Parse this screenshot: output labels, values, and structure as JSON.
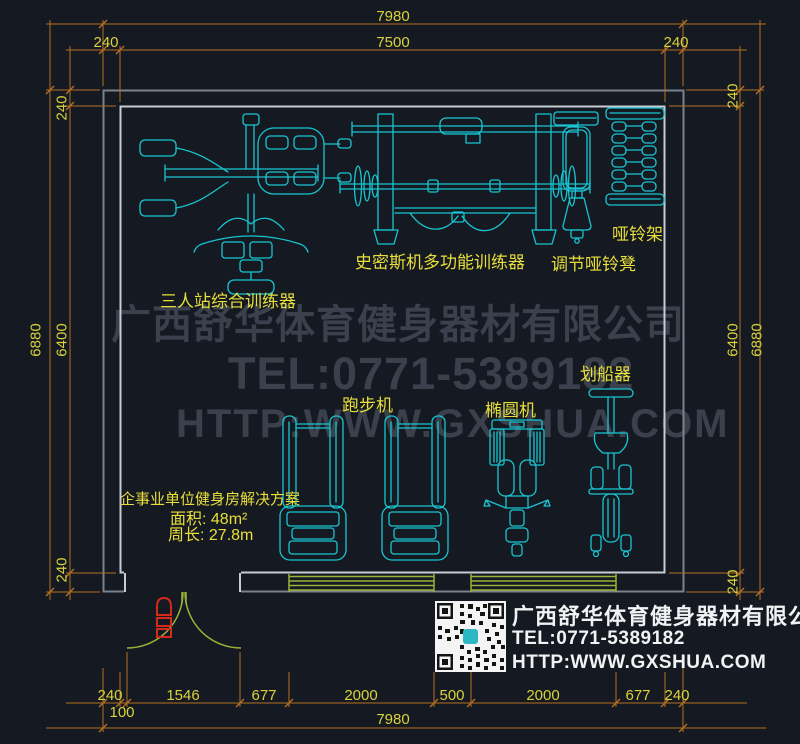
{
  "colors": {
    "background": "#151a22",
    "dimension_line": "#b56f23",
    "dimension_text": "#d9d23b",
    "equipment_line": "#18c5d1",
    "label_text": "#e8df3a",
    "wall_outer": "#7b828c",
    "wall_inner": "#c6ccd4",
    "window_line": "#9ab338",
    "door_marker": "#d42a1a",
    "watermark_text": "#3a414d",
    "footer_text": "#f0f2f4"
  },
  "dimensions": {
    "top": {
      "overall": "7980",
      "inner": "7500",
      "left_offset": "240",
      "right_offset": "240"
    },
    "bottom": {
      "segments": [
        "240",
        "1546",
        "677",
        "2000",
        "500",
        "2000",
        "677",
        "240"
      ],
      "sub_offset": "100",
      "overall": "7980"
    },
    "left": {
      "overall": "6880",
      "inner": "6400",
      "top_offset": "240",
      "bottom_offset": "240"
    },
    "right": {
      "inner": "6400",
      "overall": "6880",
      "top_offset": "240",
      "bottom_offset": "240"
    }
  },
  "equipment_labels": {
    "three_station": "三人站综合训练器",
    "smith": "史密斯机多功能训练器",
    "dumbbell_rack": "哑铃架",
    "dumbbell_bench": "调节哑铃凳",
    "treadmill": "跑步机",
    "elliptical": "椭圆机",
    "rower": "划船器"
  },
  "info_block": {
    "title": "企事业单位健身房解决方案",
    "area": "面积: 48m²",
    "perimeter": "周长: 27.8m"
  },
  "watermark": {
    "company": "广西舒华体育健身器材有限公司",
    "tel": "TEL:0771-5389182",
    "web": "HTTP:WWW.GXSHUA.COM"
  },
  "footer": {
    "company": "广西舒华体育健身器材有限公司",
    "tel": "TEL:0771-5389182",
    "web": "HTTP:WWW.GXSHUA.COM"
  }
}
